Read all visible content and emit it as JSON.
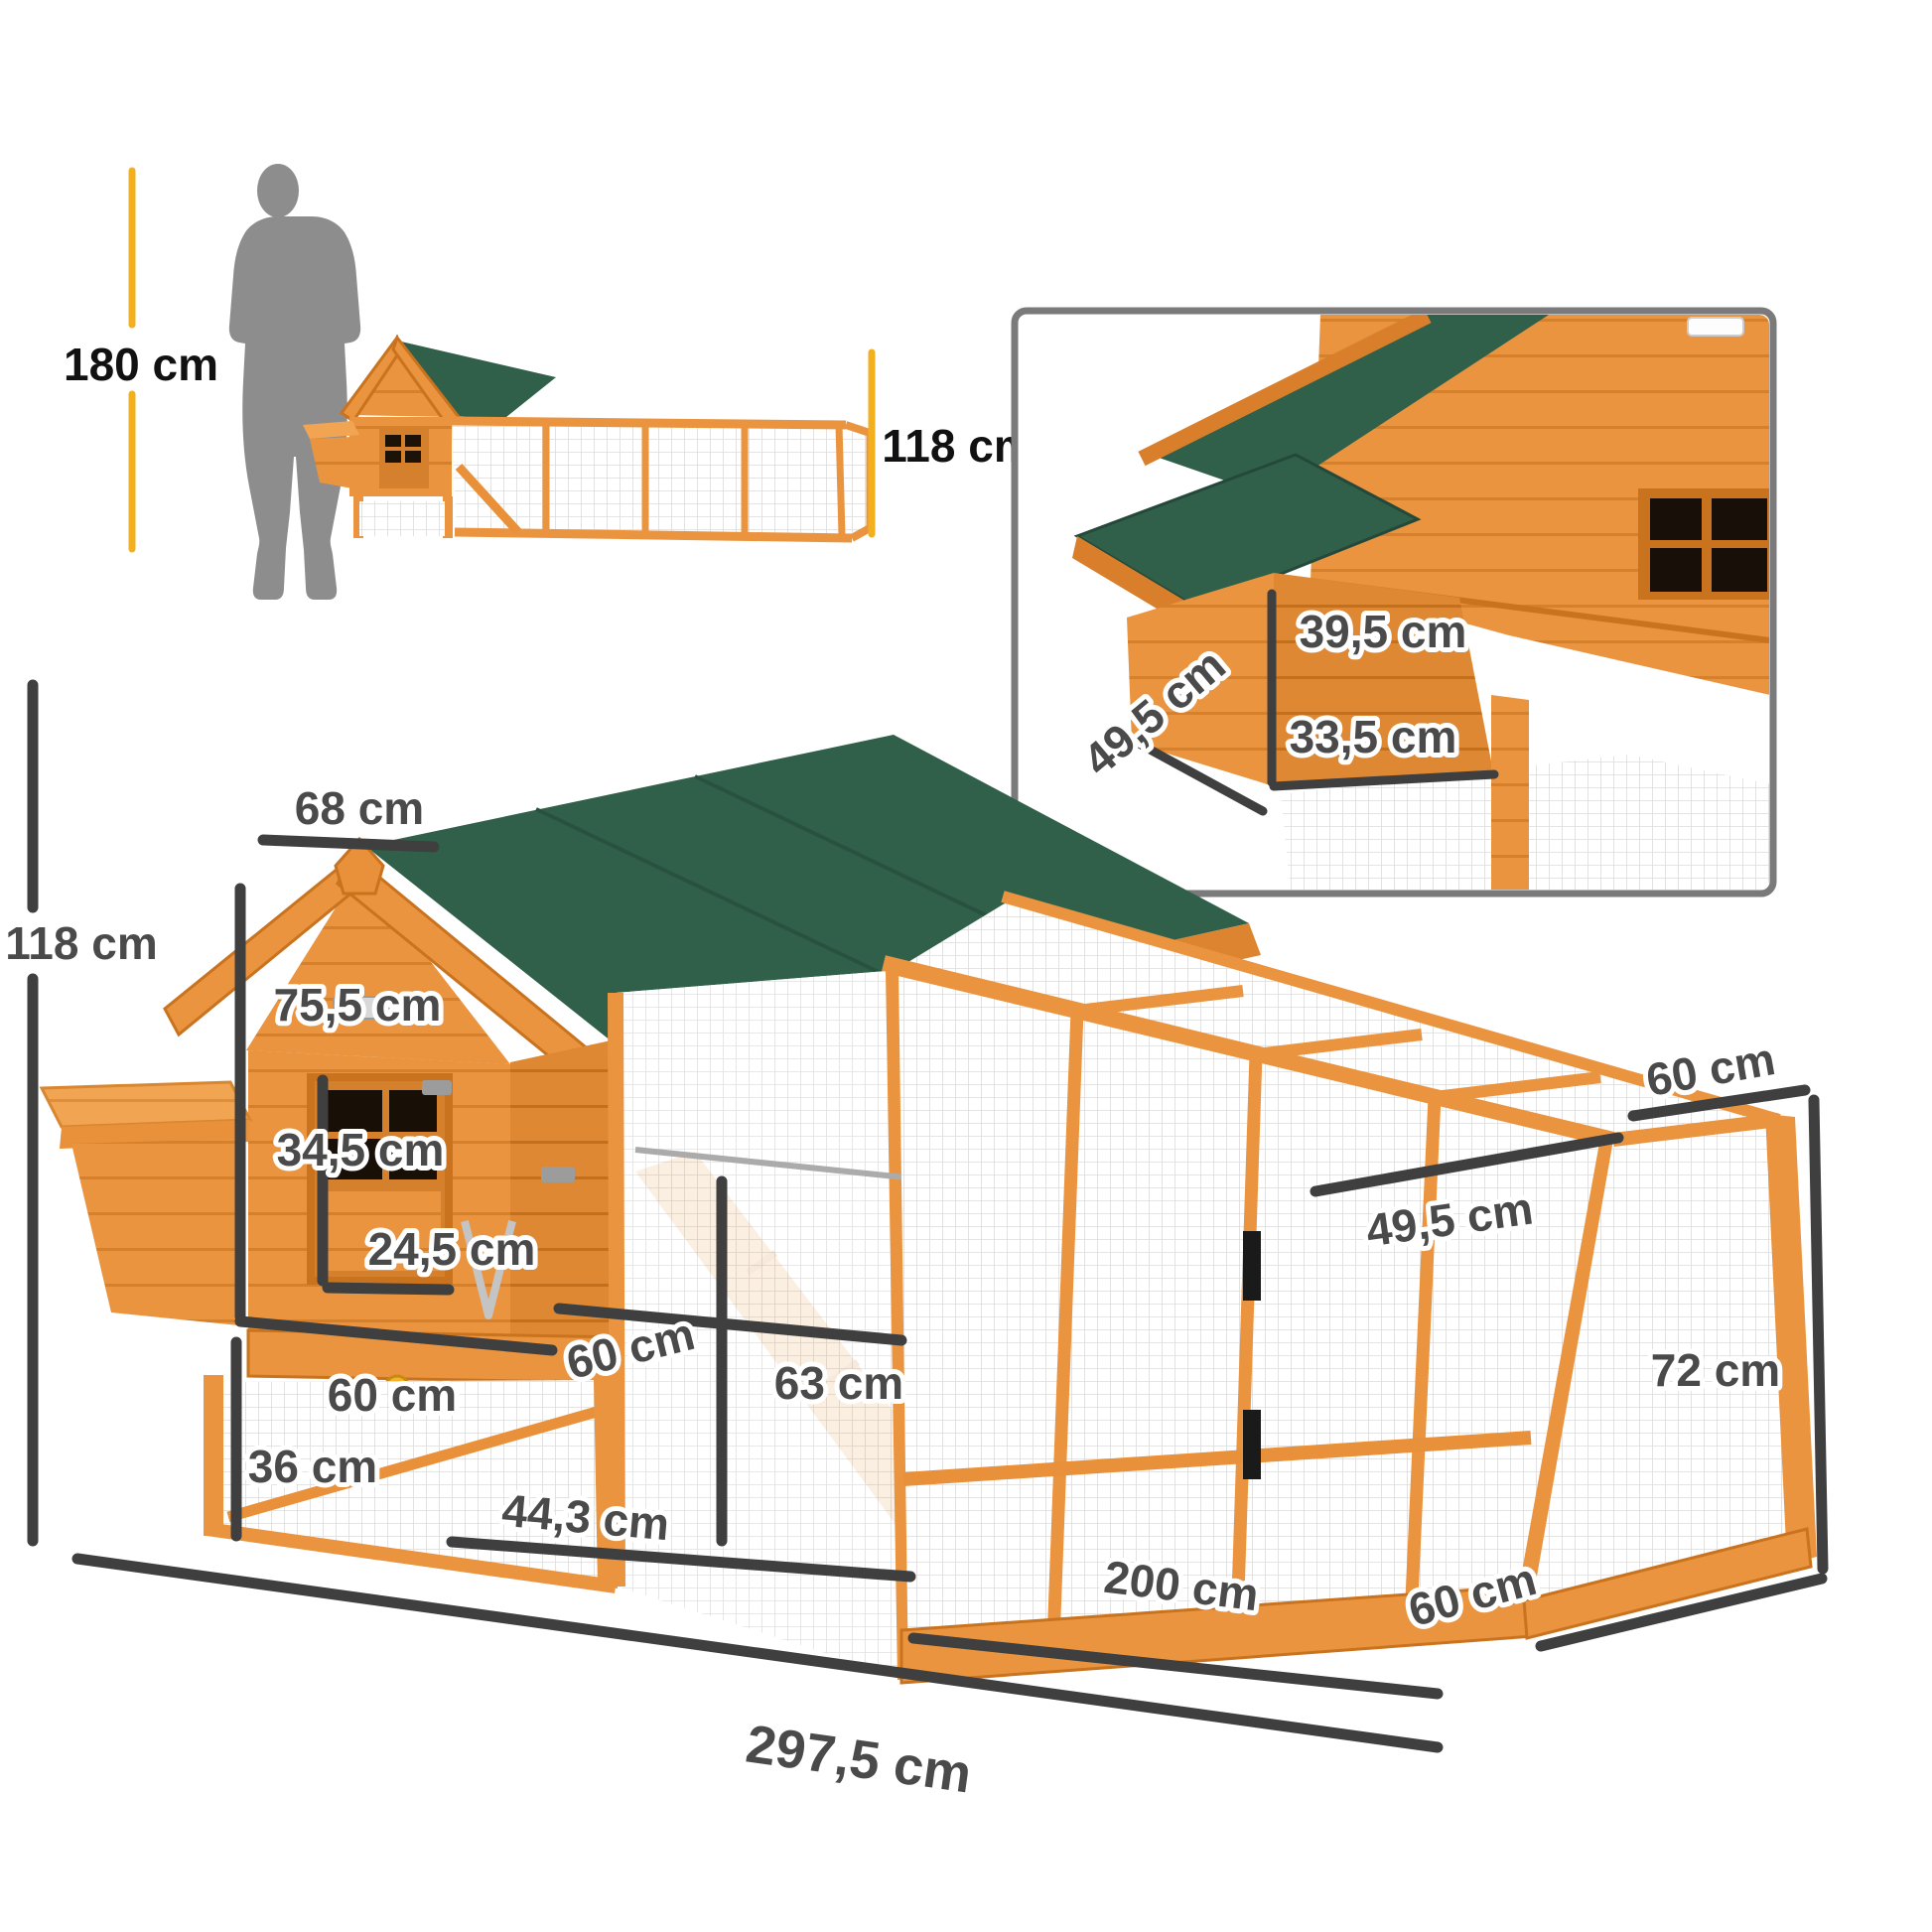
{
  "scale": {
    "person_label": "180 cm",
    "coop_label": "118 cm"
  },
  "inset": {
    "dim_top": "39,5 cm",
    "dim_side": "49,5 cm",
    "dim_bottom": "33,5 cm"
  },
  "main": {
    "roof_width": "68 cm",
    "total_height": "118 cm",
    "house_height": "75,5 cm",
    "door_height": "34,5 cm",
    "door_width": "24,5 cm",
    "house_depth": "60 cm",
    "ground_clearance": "36 cm",
    "run_door_width": "60 cm",
    "run_inner_height": "63 cm",
    "left_run_width": "44,3 cm",
    "run_length": "200 cm",
    "total_length": "297,5 cm",
    "run_depth_top": "60 cm",
    "top_panel_width": "49,5 cm",
    "mesh_panel_height": "72 cm",
    "run_depth_bottom": "60 cm"
  },
  "colors": {
    "wood": "#EA9440",
    "wood_dark": "#DE8833",
    "wood_trim": "#C9731F",
    "roof_green": "#30604A",
    "dimension_gray": "#3F3F3F",
    "scale_yellow": "#F2B01E",
    "silhouette_gray": "#8D8D8D"
  }
}
